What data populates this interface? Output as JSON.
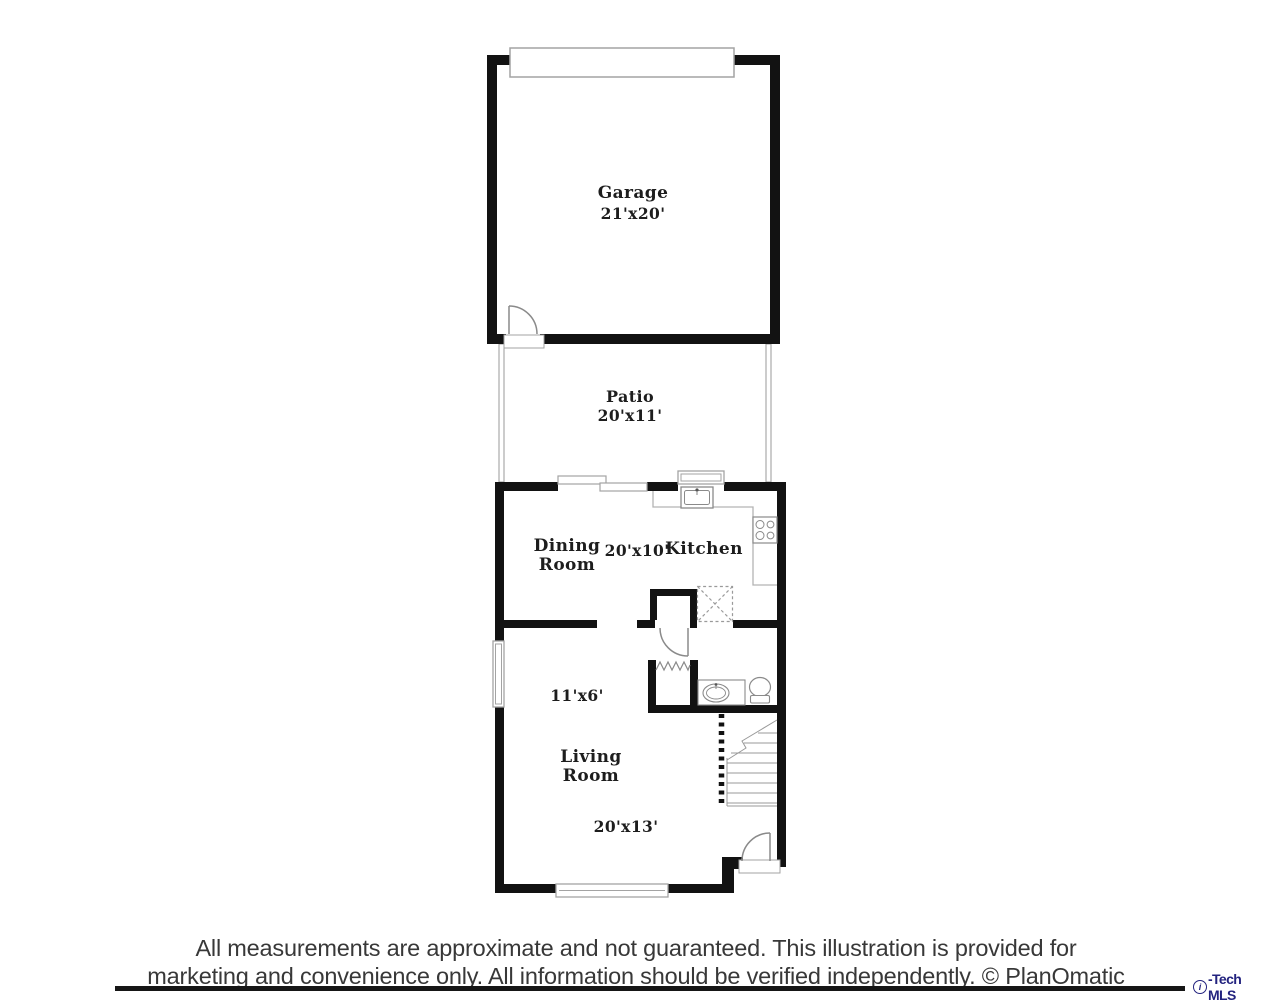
{
  "floorplan": {
    "garage": {
      "name": "Garage",
      "dims": "21'x20'"
    },
    "patio": {
      "name": "Patio",
      "dims": "20'x11'"
    },
    "dining": {
      "name": "Dining\nRoom",
      "dims": "20'x10'"
    },
    "kitchen": {
      "name": "Kitchen"
    },
    "hall": {
      "dims": "11'x6'"
    },
    "living": {
      "name": "Living\nRoom",
      "dims": "20'x13'"
    }
  },
  "footer": {
    "disclaimer_line1": "All measurements are approximate and not guaranteed. This illustration is provided for",
    "disclaimer_line2": "marketing and convenience only. All information should be verified independently. © PlanOmatic",
    "logo_circle_letter": "i",
    "logo_text": "-Tech MLS"
  }
}
